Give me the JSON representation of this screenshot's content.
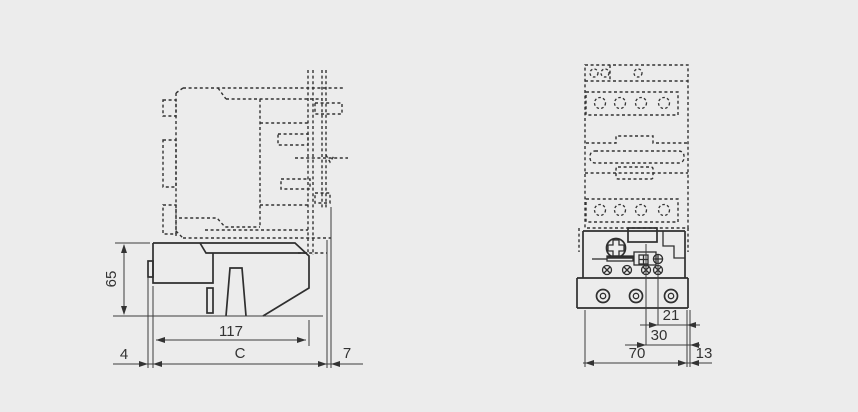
{
  "drawing": {
    "description": "Overload relay and contactor outline dimension drawing",
    "colors": {
      "background": "#ececec",
      "line": "#333333"
    },
    "side_view": {
      "dim_height": "65",
      "dim_width": "117",
      "dim_clip_offset": "4",
      "dim_depth": "C",
      "dim_rail_offset": "7"
    },
    "front_view": {
      "dim_terminal_a": "21",
      "dim_terminal_b": "30",
      "dim_width": "70",
      "dim_side_offset": "13"
    }
  }
}
